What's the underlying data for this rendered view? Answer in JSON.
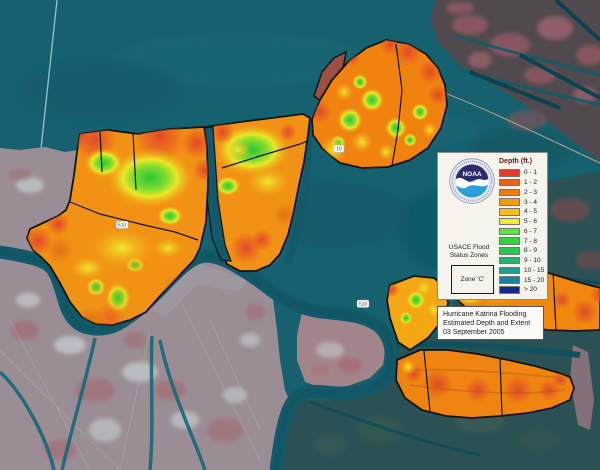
{
  "legend": {
    "depth_title": "Depth (ft.)",
    "items": [
      {
        "label": "0 - 1",
        "color": "#e23b28"
      },
      {
        "label": "1 - 2",
        "color": "#ec6018"
      },
      {
        "label": "2 - 3",
        "color": "#f07c12"
      },
      {
        "label": "3 - 4",
        "color": "#f49b16"
      },
      {
        "label": "4 - 5",
        "color": "#f7bc1e"
      },
      {
        "label": "5 - 6",
        "color": "#f2ec31"
      },
      {
        "label": "6 - 7",
        "color": "#57e83c"
      },
      {
        "label": "7 - 8",
        "color": "#2fd73c"
      },
      {
        "label": "8 - 9",
        "color": "#27c753"
      },
      {
        "label": "9 - 10",
        "color": "#27b275"
      },
      {
        "label": "10 - 15",
        "color": "#1f9d8d"
      },
      {
        "label": "15 - 20",
        "color": "#1b7fa0"
      },
      {
        "label": "> 20",
        "color": "#15268c"
      }
    ],
    "usace_line1": "USACE Flood",
    "usace_line2": "Status Zones",
    "zone_label": "Zone 'C'",
    "noaa_text": "NOAA"
  },
  "title_box": {
    "line1": "Hurricane Katrina Flooding",
    "line2": "Estimated Depth and Extent",
    "line3": "03 September 2005"
  },
  "map": {
    "road_labels": [
      {
        "text": "610"
      },
      {
        "text": "10"
      },
      {
        "text": "510"
      }
    ],
    "colors": {
      "water": "#15616f",
      "urban_land": "#9b8d95",
      "marsh": "#6f4a50",
      "flood_base_orange": "#f29214",
      "flood_green": "#2ec437",
      "flood_yellow": "#f0e82c",
      "flood_red": "#e2432a",
      "outline_black": "#141414"
    }
  }
}
